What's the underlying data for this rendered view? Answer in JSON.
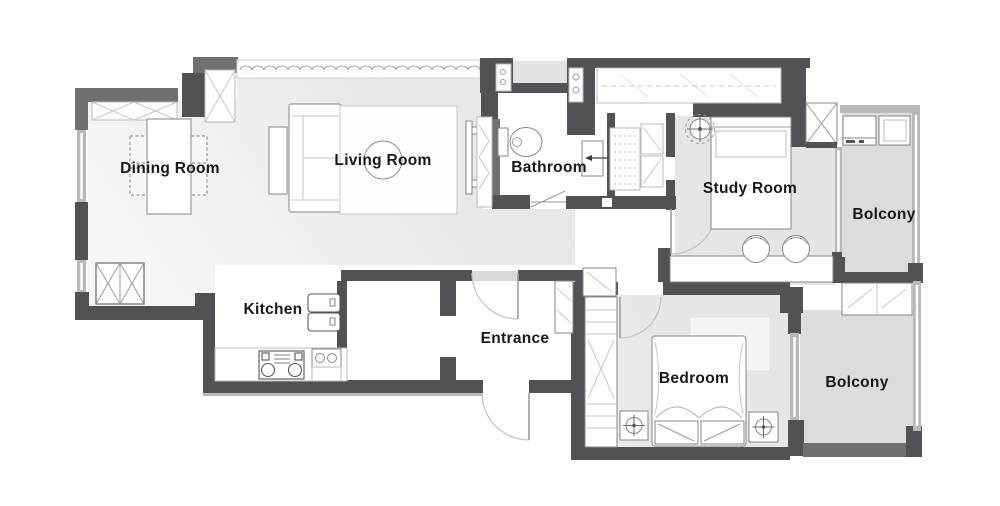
{
  "floorplan": {
    "colors": {
      "wall_dark": "#515256",
      "wall_medium": "#6f7073",
      "wall_light": "#b8b9bb",
      "floor_main": "#e8e8e9",
      "floor_balcony": "#dcdcdd",
      "floor_white": "#ffffff",
      "furniture_stroke": "#85868a",
      "label_text": "#17181a"
    },
    "rooms": [
      {
        "name": "dining-room",
        "label": "Dining Room"
      },
      {
        "name": "living-room",
        "label": "Living Room"
      },
      {
        "name": "bathroom",
        "label": "Bathroom"
      },
      {
        "name": "study-room",
        "label": "Study Room"
      },
      {
        "name": "balcony-top",
        "label": "Bolcony"
      },
      {
        "name": "kitchen",
        "label": "Kitchen"
      },
      {
        "name": "entrance",
        "label": "Entrance"
      },
      {
        "name": "bedroom",
        "label": "Bedroom"
      },
      {
        "name": "balcony-bottom",
        "label": "Bolcony"
      }
    ],
    "furniture_icons": [
      "dining-table",
      "dining-chair",
      "storage-cabinet",
      "wardrobe-closet",
      "sofa",
      "side-table",
      "area-rug",
      "coffee-table",
      "tv",
      "curtain-window",
      "toilet",
      "bathroom-sink",
      "sliding-door",
      "hanging-rail-closet",
      "linen-shelves",
      "single-bed",
      "double-bed",
      "ceiling-fan",
      "desk",
      "desk-chair",
      "washing-machine",
      "laundry-sink",
      "balcony-cabinet",
      "shoe-cabinet",
      "kitchen-counter",
      "stove",
      "kitchen-sink",
      "kitchen-cabinet",
      "nightstand",
      "bedroom-rug",
      "door-swing"
    ]
  }
}
